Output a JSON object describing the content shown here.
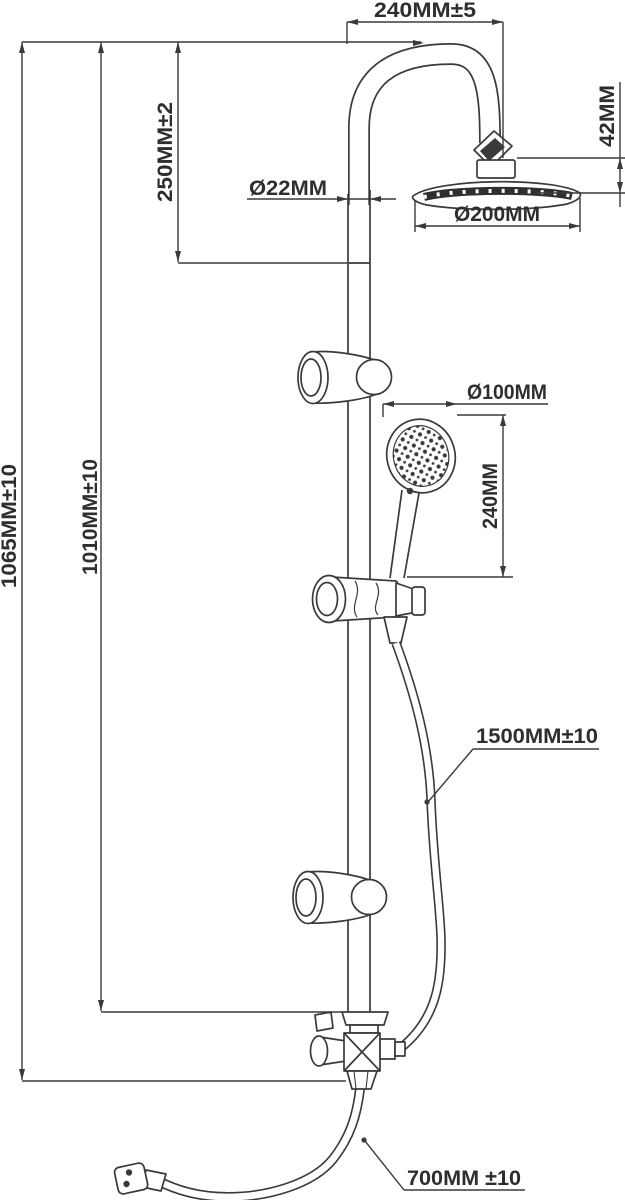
{
  "drawing": {
    "title": "shower-column-technical-drawing",
    "units": "MM",
    "colors": {
      "line": "#3a3a3a",
      "text": "#2e2e2e",
      "background": "#ffffff"
    },
    "labels": {
      "top_arm_reach": "240MM±5",
      "head_drop": "42MM",
      "upper_pipe_length": "250MM±2",
      "pipe_diameter": "Ø22MM",
      "head_diameter": "Ø200MM",
      "hand_shower_diameter": "Ø100MM",
      "hand_shower_length": "240MM",
      "total_height": "1065MM±10",
      "riser_height": "1010MM±10",
      "shower_hose_length": "1500MM±10",
      "inlet_hose_length": "700MM ±10"
    }
  }
}
